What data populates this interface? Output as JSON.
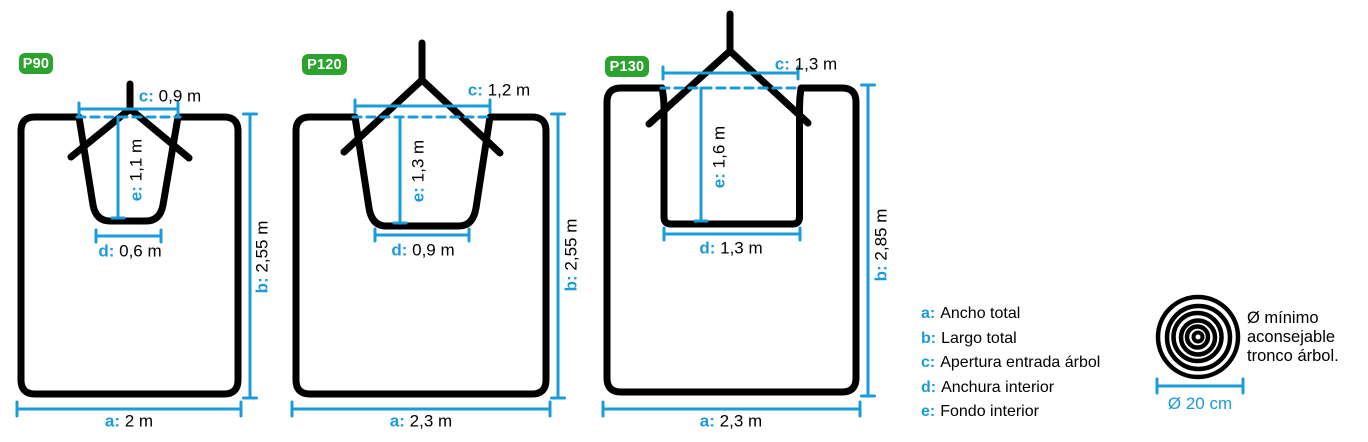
{
  "colors": {
    "accent_blue": "#1b9cd8",
    "badge_green": "#2da32f",
    "ink": "#000000"
  },
  "machines": [
    {
      "label": "P90",
      "dims": {
        "a": {
          "k": "a:",
          "v": "2 m"
        },
        "b": {
          "k": "b:",
          "v": "2,55 m"
        },
        "c": {
          "k": "c:",
          "v": "0,9 m"
        },
        "d": {
          "k": "d:",
          "v": "0,6 m"
        },
        "e": {
          "k": "e:",
          "v": "1,1 m"
        }
      }
    },
    {
      "label": "P120",
      "dims": {
        "a": {
          "k": "a:",
          "v": "2,3 m"
        },
        "b": {
          "k": "b:",
          "v": "2,55 m"
        },
        "c": {
          "k": "c:",
          "v": "1,2 m"
        },
        "d": {
          "k": "d:",
          "v": "0,9 m"
        },
        "e": {
          "k": "e:",
          "v": "1,3 m"
        }
      }
    },
    {
      "label": "P130",
      "dims": {
        "a": {
          "k": "a:",
          "v": "2,3 m"
        },
        "b": {
          "k": "b:",
          "v": "2,85 m"
        },
        "c": {
          "k": "c:",
          "v": "1,3 m"
        },
        "d": {
          "k": "d:",
          "v": "1,3 m"
        },
        "e": {
          "k": "e:",
          "v": "1,6 m"
        }
      }
    }
  ],
  "legend": {
    "items": [
      {
        "k": "a:",
        "v": "Ancho total"
      },
      {
        "k": "b:",
        "v": "Largo total"
      },
      {
        "k": "c:",
        "v": "Apertura entrada árbol"
      },
      {
        "k": "d:",
        "v": "Anchura interior"
      },
      {
        "k": "e:",
        "v": "Fondo interior"
      }
    ]
  },
  "trunk": {
    "note_line1": "Ø mínimo",
    "note_line2": "aconsejable",
    "note_line3": "tronco árbol.",
    "diameter": "Ø 20 cm"
  }
}
